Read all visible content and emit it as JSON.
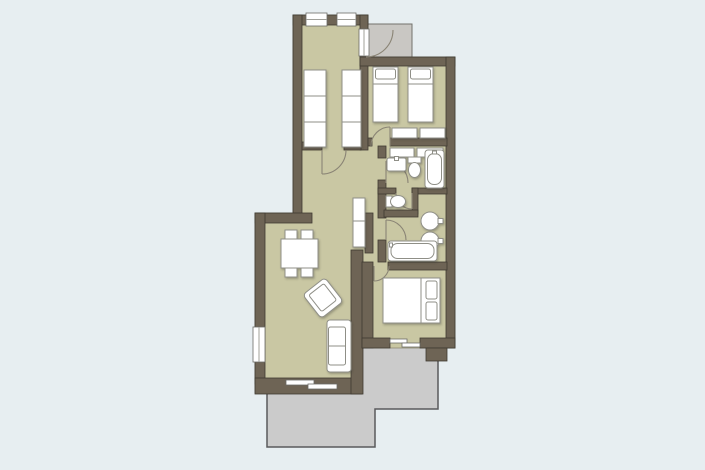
{
  "canvas": {
    "width": 705,
    "height": 470
  },
  "colors": {
    "background": "#e7eef1",
    "wall": "#6e6455",
    "wall_outline": "#3f3a31",
    "floor": "#c9c7a3",
    "floor_outline": "#8b8770",
    "terrace": "#cbcbcb",
    "terrace_outline": "#5a5a5c",
    "porch": "#c9c7c3",
    "porch_outline": "#73716c",
    "furniture_fill": "#ffffff",
    "furniture_outline": "#8f8f87",
    "door_arc": "#8a8475",
    "overlay_outline": "#6b6b66",
    "glass_line": "#a0a09a"
  },
  "plan": {
    "terrace": {
      "name": "terrace",
      "points": "267,389 362,389 362,347 438,347 438,409 375,409 375,447 267,447"
    },
    "porch": {
      "name": "entry-porch",
      "x": 366,
      "y": 24,
      "w": 46,
      "h": 33
    },
    "floor": {
      "name": "apartment-floor",
      "points": "293,15 368,15 368,57 455,57 455,348 362,348 362,393 255,393 255,213 293,213"
    },
    "walls": [
      {
        "name": "wall-corridor-north",
        "x": 293,
        "y": 15,
        "w": 75,
        "h": 10
      },
      {
        "name": "wall-corridor-west",
        "x": 293,
        "y": 15,
        "w": 9,
        "h": 200
      },
      {
        "name": "wall-living-north",
        "x": 255,
        "y": 213,
        "w": 57,
        "h": 10
      },
      {
        "name": "wall-living-west",
        "x": 255,
        "y": 213,
        "w": 10,
        "h": 171
      },
      {
        "name": "wall-living-south",
        "x": 255,
        "y": 378,
        "w": 107,
        "h": 16
      },
      {
        "name": "wall-corridor-east",
        "x": 360,
        "y": 15,
        "w": 8,
        "h": 135
      },
      {
        "name": "wall-twinroom-north",
        "x": 360,
        "y": 57,
        "w": 95,
        "h": 9
      },
      {
        "name": "wall-east-exterior",
        "x": 446,
        "y": 57,
        "w": 9,
        "h": 291
      },
      {
        "name": "wall-twinroom-south-a",
        "x": 368,
        "y": 138,
        "w": 4,
        "h": 8
      },
      {
        "name": "wall-twinroom-south-b",
        "x": 390,
        "y": 138,
        "w": 57,
        "h": 8
      },
      {
        "name": "wall-hall-divider-a",
        "x": 302,
        "y": 142,
        "w": 20,
        "h": 8
      },
      {
        "name": "wall-hall-divider-b",
        "x": 344,
        "y": 142,
        "w": 17,
        "h": 8
      },
      {
        "name": "wall-bath-west-a",
        "x": 378,
        "y": 146,
        "w": 8,
        "h": 12
      },
      {
        "name": "wall-bath-west-b",
        "x": 378,
        "y": 180,
        "w": 8,
        "h": 38
      },
      {
        "name": "wall-bath-west-c",
        "x": 378,
        "y": 240,
        "w": 8,
        "h": 22
      },
      {
        "name": "wall-bath1-wc-a",
        "x": 378,
        "y": 188,
        "w": 18,
        "h": 6
      },
      {
        "name": "wall-bath1-wc-b",
        "x": 412,
        "y": 188,
        "w": 35,
        "h": 6
      },
      {
        "name": "wall-wc-east",
        "x": 412,
        "y": 188,
        "w": 6,
        "h": 26
      },
      {
        "name": "wall-wc-south",
        "x": 384,
        "y": 210,
        "w": 34,
        "h": 7
      },
      {
        "name": "wall-bath2-bedroom",
        "x": 388,
        "y": 262,
        "w": 59,
        "h": 8
      },
      {
        "name": "wall-living-east-upper",
        "x": 365,
        "y": 213,
        "w": 8,
        "h": 40
      },
      {
        "name": "wall-living-east-lower",
        "x": 351,
        "y": 250,
        "w": 12,
        "h": 144
      },
      {
        "name": "wall-bedroom-west",
        "x": 362,
        "y": 262,
        "w": 11,
        "h": 86
      },
      {
        "name": "wall-bedroom-south-a",
        "x": 362,
        "y": 338,
        "w": 28,
        "h": 10
      },
      {
        "name": "wall-bedroom-south-b",
        "x": 420,
        "y": 338,
        "w": 35,
        "h": 10
      },
      {
        "name": "wall-se-corner-block",
        "x": 426,
        "y": 348,
        "w": 21,
        "h": 13
      }
    ],
    "windows": [
      {
        "name": "window-corridor-1",
        "x": 306,
        "y": 13,
        "w": 21,
        "h": 13,
        "mid": "h"
      },
      {
        "name": "window-corridor-2",
        "x": 337,
        "y": 13,
        "w": 19,
        "h": 13,
        "mid": "h"
      },
      {
        "name": "window-living-west",
        "x": 253,
        "y": 327,
        "w": 12,
        "h": 35,
        "mid": "v"
      },
      {
        "name": "entry-door-opening",
        "x": 359,
        "y": 29,
        "w": 10,
        "h": 27,
        "mid": "v"
      }
    ],
    "sliding_doors": [
      {
        "name": "terrace-door-living-panel",
        "x": 286,
        "y": 380,
        "w": 28,
        "h": 5
      },
      {
        "name": "terrace-door-living-panel",
        "x": 308,
        "y": 384,
        "w": 29,
        "h": 5
      },
      {
        "name": "terrace-door-bedroom-panel",
        "x": 390,
        "y": 339,
        "w": 17,
        "h": 4
      },
      {
        "name": "terrace-door-bedroom-panel",
        "x": 402,
        "y": 343,
        "w": 18,
        "h": 4
      }
    ],
    "door_arcs": [
      {
        "name": "entry-door-arc",
        "d": "M 366 57 A 27 27 0 0 0 393 30"
      },
      {
        "name": "corridor-door-arc",
        "d": "M 322 174 A 24 24 0 0 0 346 150"
      },
      {
        "name": "corridor-door-leaf",
        "d": "M 322 150 L 322 174"
      },
      {
        "name": "twinroom-door-arc",
        "d": "M 390 127 A 19 19 0 0 0 371 146"
      },
      {
        "name": "twinroom-door-leaf",
        "d": "M 390 146 L 390 127"
      },
      {
        "name": "bath1-door-arc",
        "d": "M 386 161 A 22 22 0 0 1 408 183"
      },
      {
        "name": "bath1-door-leaf",
        "d": "M 386 183 L 386 161"
      },
      {
        "name": "wc-door-arc",
        "d": "M 412 209 A 16 16 0 0 1 396 193"
      },
      {
        "name": "wc-door-leaf",
        "d": "M 412 193 L 412 209"
      },
      {
        "name": "bath2-door-arc",
        "d": "M 386 220 A 20 20 0 0 1 406 240"
      },
      {
        "name": "bath2-door-leaf",
        "d": "M 386 240 L 386 220"
      },
      {
        "name": "bedroom-door-arc",
        "d": "M 374 281 A 15 15 0 0 0 389 266"
      },
      {
        "name": "bedroom-door-leaf",
        "d": "M 374 266 L 374 281"
      }
    ],
    "furniture": [
      {
        "k": "r",
        "n": "wardrobe-left",
        "x": 304,
        "y": 70,
        "w": 22,
        "h": 77
      },
      {
        "k": "l",
        "n": "wardrobe-left-shelf",
        "x1": 304,
        "y1": 96,
        "x2": 326,
        "y2": 96
      },
      {
        "k": "l",
        "n": "wardrobe-left-shelf",
        "x1": 304,
        "y1": 122,
        "x2": 326,
        "y2": 122
      },
      {
        "k": "r",
        "n": "wardrobe-right",
        "x": 342,
        "y": 70,
        "w": 19,
        "h": 77
      },
      {
        "k": "l",
        "n": "wardrobe-right-shelf",
        "x1": 342,
        "y1": 96,
        "x2": 361,
        "y2": 96
      },
      {
        "k": "l",
        "n": "wardrobe-right-shelf",
        "x1": 342,
        "y1": 122,
        "x2": 361,
        "y2": 122
      },
      {
        "k": "r",
        "n": "single-bed-1",
        "x": 373,
        "y": 67,
        "w": 25,
        "h": 55
      },
      {
        "k": "rr",
        "n": "single-bed-1-pillow",
        "x": 375.5,
        "y": 69,
        "w": 20,
        "h": 10,
        "rx": 2
      },
      {
        "k": "l",
        "n": "single-bed-1-blanket",
        "x1": 373,
        "y1": 84,
        "x2": 398,
        "y2": 84
      },
      {
        "k": "r",
        "n": "single-bed-2",
        "x": 408,
        "y": 67,
        "w": 25,
        "h": 55
      },
      {
        "k": "rr",
        "n": "single-bed-2-pillow",
        "x": 410.5,
        "y": 69,
        "w": 20,
        "h": 10,
        "rx": 2
      },
      {
        "k": "l",
        "n": "single-bed-2-blanket",
        "x1": 408,
        "y1": 84,
        "x2": 433,
        "y2": 84
      },
      {
        "k": "r",
        "n": "dresser-1",
        "x": 392,
        "y": 128,
        "w": 25,
        "h": 10
      },
      {
        "k": "r",
        "n": "dresser-2",
        "x": 420,
        "y": 128,
        "w": 25,
        "h": 10
      },
      {
        "k": "r",
        "n": "bath1-cabinet-1",
        "x": 390,
        "y": 148,
        "w": 24,
        "h": 9
      },
      {
        "k": "r",
        "n": "bath1-cabinet-2",
        "x": 417,
        "y": 148,
        "w": 26,
        "h": 9
      },
      {
        "k": "rr",
        "n": "bath1-sink",
        "x": 387,
        "y": 158,
        "w": 19,
        "h": 13,
        "rx": 2
      },
      {
        "k": "r",
        "n": "bath1-sink-faucet",
        "x": 394.5,
        "y": 156.5,
        "w": 4,
        "h": 4
      },
      {
        "k": "r",
        "n": "bath1-toilet-tank",
        "x": 408,
        "y": 157,
        "w": 13,
        "h": 6
      },
      {
        "k": "e",
        "n": "bath1-toilet-bowl",
        "cx": 414.5,
        "cy": 170,
        "rx": 6,
        "ry": 7.5
      },
      {
        "k": "rr",
        "n": "bath1-bathtub",
        "x": 425,
        "y": 150,
        "w": 19,
        "h": 38,
        "rx": 3
      },
      {
        "k": "rr",
        "n": "bath1-bathtub-inner",
        "x": 427.5,
        "y": 153.5,
        "w": 14,
        "h": 31,
        "rx": 6.5
      },
      {
        "k": "r",
        "n": "bath1-tub-faucet",
        "x": 432.5,
        "y": 151,
        "w": 4,
        "h": 3
      },
      {
        "k": "r",
        "n": "wc-toilet-tank",
        "x": 386,
        "y": 196,
        "w": 6,
        "h": 11
      },
      {
        "k": "e",
        "n": "wc-toilet-bowl",
        "cx": 398,
        "cy": 201.5,
        "rx": 7.5,
        "ry": 6
      },
      {
        "k": "c",
        "n": "bath2-basin-1",
        "cx": 430,
        "cy": 221,
        "r": 9
      },
      {
        "k": "r",
        "n": "bath2-basin-1-faucet",
        "x": 438,
        "y": 218.5,
        "w": 5,
        "h": 5
      },
      {
        "k": "c",
        "n": "bath2-basin-2",
        "cx": 430,
        "cy": 241,
        "r": 9
      },
      {
        "k": "r",
        "n": "bath2-basin-2-faucet",
        "x": 438,
        "y": 238.5,
        "w": 5,
        "h": 5
      },
      {
        "k": "rr",
        "n": "bath2-bathtub",
        "x": 388,
        "y": 241,
        "w": 49,
        "h": 20,
        "rx": 3
      },
      {
        "k": "rr",
        "n": "bath2-bathtub-inner",
        "x": 391,
        "y": 243.5,
        "w": 43,
        "h": 15,
        "rx": 6.5
      },
      {
        "k": "r",
        "n": "bath2-tub-faucet",
        "x": 389.5,
        "y": 243,
        "w": 3,
        "h": 4
      },
      {
        "k": "r",
        "n": "hall-cabinet",
        "x": 353,
        "y": 198,
        "w": 12,
        "h": 49
      },
      {
        "k": "l",
        "n": "hall-cabinet-divider",
        "x1": 353,
        "y1": 221,
        "x2": 365,
        "y2": 221
      },
      {
        "k": "r",
        "n": "chair",
        "x": 285,
        "y": 230,
        "w": 12,
        "h": 9
      },
      {
        "k": "r",
        "n": "chair",
        "x": 301,
        "y": 230,
        "w": 12,
        "h": 9
      },
      {
        "k": "r",
        "n": "chair",
        "x": 285,
        "y": 268,
        "w": 12,
        "h": 9
      },
      {
        "k": "r",
        "n": "chair",
        "x": 301,
        "y": 268,
        "w": 12,
        "h": 9
      },
      {
        "k": "r",
        "n": "dining-table",
        "x": 281,
        "y": 239,
        "w": 37,
        "h": 29
      },
      {
        "k": "rr",
        "n": "armchair",
        "x": 309,
        "y": 283,
        "w": 28,
        "h": 30,
        "rx": 4,
        "rot": "-38 323 298"
      },
      {
        "k": "rr",
        "n": "armchair-seat",
        "x": 313.5,
        "y": 287,
        "w": 19,
        "h": 21,
        "rx": 2,
        "rot": "-38 323 298"
      },
      {
        "k": "rr",
        "n": "sofa",
        "x": 327,
        "y": 320,
        "w": 24,
        "h": 52,
        "rx": 3
      },
      {
        "k": "rr",
        "n": "sofa-seat",
        "x": 328.5,
        "y": 327,
        "w": 17,
        "h": 38,
        "rx": 2
      },
      {
        "k": "l",
        "n": "sofa-cushion-divider",
        "x1": 328.5,
        "y1": 346,
        "x2": 345.5,
        "y2": 346
      },
      {
        "k": "r",
        "n": "double-bed",
        "x": 383,
        "y": 278,
        "w": 57,
        "h": 45
      },
      {
        "k": "rr",
        "n": "double-bed-pillow",
        "x": 426,
        "y": 281,
        "w": 11,
        "h": 18,
        "rx": 2
      },
      {
        "k": "rr",
        "n": "double-bed-pillow",
        "x": 426,
        "y": 302,
        "w": 11,
        "h": 18,
        "rx": 2
      },
      {
        "k": "l",
        "n": "double-bed-blanket",
        "x1": 421,
        "y1": 278,
        "x2": 421,
        "y2": 323
      }
    ]
  }
}
